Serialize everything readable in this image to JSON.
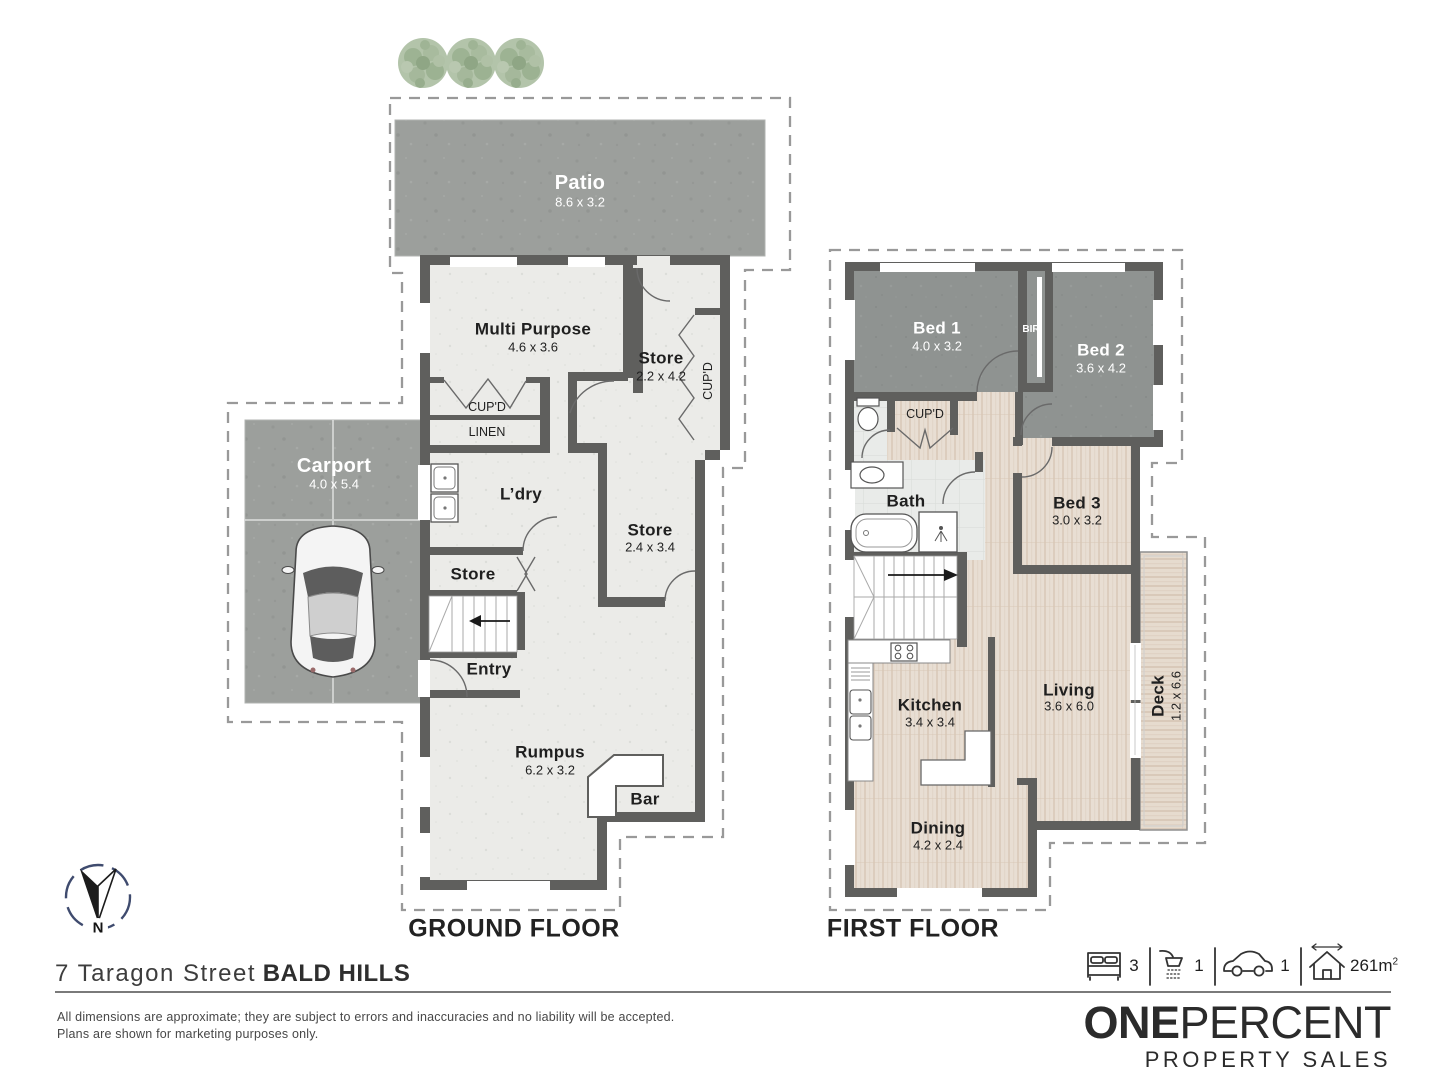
{
  "ground_floor": {
    "title": "GROUND FLOOR",
    "patio": {
      "name": "Patio",
      "dims": "8.6 x 3.2"
    },
    "multi_purpose": {
      "name": "Multi Purpose",
      "dims": "4.6 x 3.6"
    },
    "store_upper": {
      "name": "Store",
      "dims": "2.2 x 4.2"
    },
    "cupd_vertical": "CUP'D",
    "cupd": "CUP'D",
    "linen": "LINEN",
    "laundry": "L’dry",
    "store_mid": {
      "name": "Store",
      "dims": "2.4 x 3.4"
    },
    "store_small": "Store",
    "entry": "Entry",
    "rumpus": {
      "name": "Rumpus",
      "dims": "6.2 x 3.2"
    },
    "bar": "Bar",
    "carport": {
      "name": "Carport",
      "dims": "4.0 x 5.4"
    }
  },
  "first_floor": {
    "title": "FIRST FLOOR",
    "bed1": {
      "name": "Bed 1",
      "dims": "4.0 x 3.2"
    },
    "bir": "BIR",
    "bed2": {
      "name": "Bed 2",
      "dims": "3.6 x 4.2"
    },
    "cupd": "CUP'D",
    "bath": "Bath",
    "bed3": {
      "name": "Bed 3",
      "dims": "3.0 x 3.2"
    },
    "kitchen": {
      "name": "Kitchen",
      "dims": "3.4 x 3.4"
    },
    "living": {
      "name": "Living",
      "dims": "3.6 x 6.0"
    },
    "deck": {
      "name": "Deck",
      "dims": "1.2 x 6.6"
    },
    "dining": {
      "name": "Dining",
      "dims": "4.2 x 2.4"
    }
  },
  "compass": {
    "north": "N"
  },
  "address": {
    "street": "7 Taragon Street",
    "suburb": "BALD HILLS"
  },
  "disclaimer": {
    "line1": "All dimensions are approximate; they are subject to errors and inaccuracies and no liability will be accepted.",
    "line2": "Plans are shown for marketing purposes only."
  },
  "features": {
    "beds": "3",
    "baths": "1",
    "cars": "1",
    "area_value": "261m",
    "area_sup": "2"
  },
  "brand": {
    "name_bold": "ONE",
    "name_light": "PERCENT",
    "tagline": "PROPERTY SALES"
  },
  "colors": {
    "wall": "#5f5f5d",
    "concrete": "#9c9f9c",
    "bedroom_carpet": "#8f9391",
    "timber_floor": "#e8ded3",
    "plan_floor": "#ebebe8",
    "tile": "#e9ebe9",
    "dashed_outline": "#999999",
    "tree_green": "#a8bb9e",
    "compass_ring": "#3f4b6e",
    "brand_text": "#2b2b2b"
  }
}
